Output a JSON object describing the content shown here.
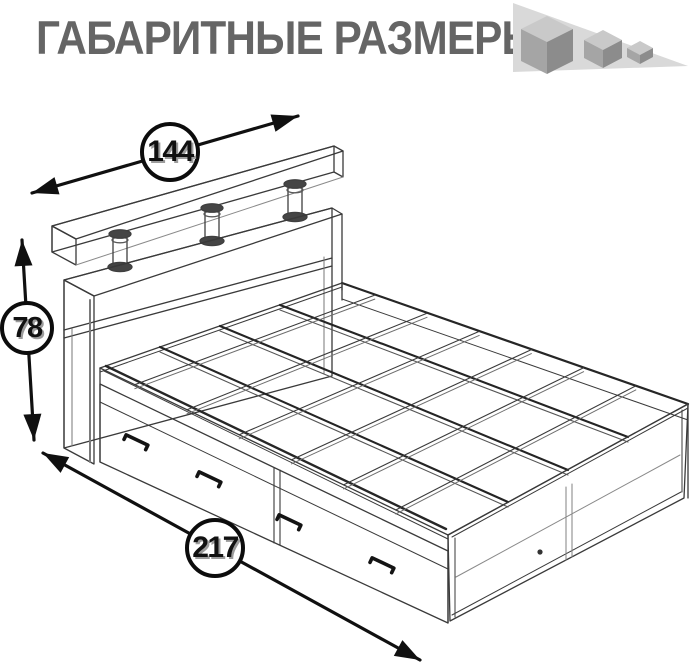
{
  "title": "ГАБАРИТНЫЕ РАЗМЕРЫ",
  "logo": {
    "icon": "three-descending-cubes",
    "cube_count": 3
  },
  "diagram": {
    "type": "isometric-wireframe-furniture-drawing",
    "subject": "bed-with-headboard-shelf-and-drawers",
    "dimensions": {
      "width": {
        "value": "144",
        "orientation": "diagonal-top"
      },
      "height": {
        "value": "78",
        "orientation": "vertical-left"
      },
      "length": {
        "value": "217",
        "orientation": "diagonal-bottom"
      }
    }
  },
  "colors": {
    "title_text": "#656565",
    "line": "#3a3a3a",
    "arrow": "#101010",
    "logo_triangle": "#d9d9d9",
    "cube_top": "#c9c9c9",
    "cube_left": "#a5a5a5",
    "cube_right": "#8c8c8c"
  }
}
